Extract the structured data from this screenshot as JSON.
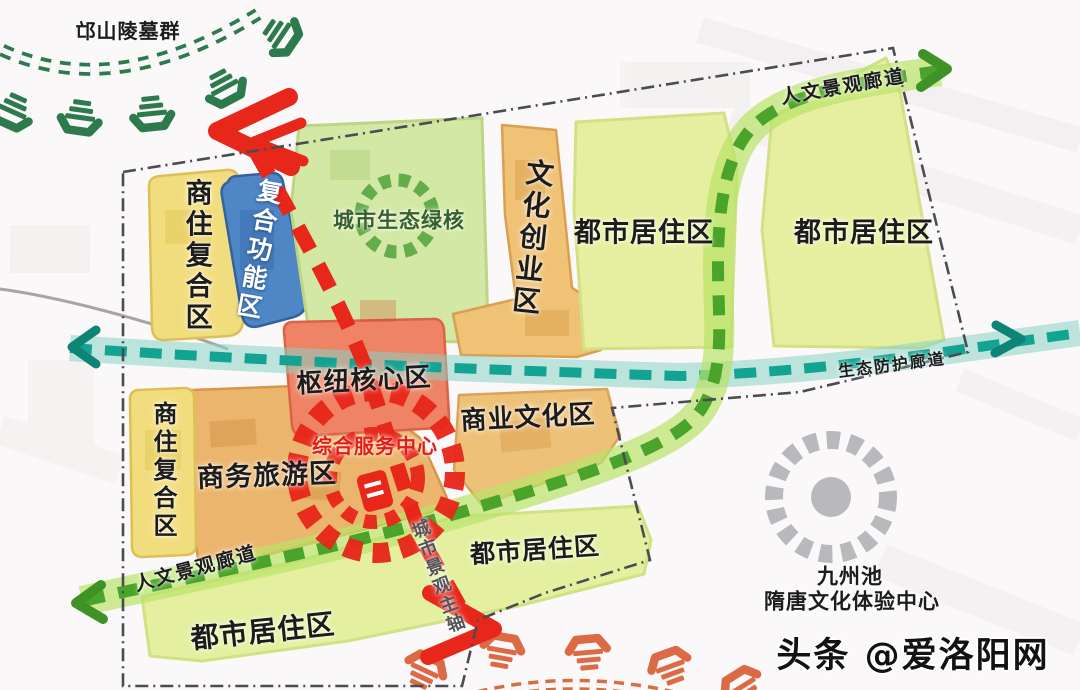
{
  "map": {
    "landmark_top": {
      "label": "邙山陵墓群"
    },
    "zones": {
      "shangzhu_top": {
        "label": "商住复合区",
        "color": "#f2dd7e"
      },
      "fuhe": {
        "label": "复合功能区",
        "color": "#4f86c6"
      },
      "green_core": {
        "label": "城市生态绿核",
        "color": "#d2e8a4"
      },
      "wenchuang": {
        "label": "文化创业区",
        "color": "#f0c276"
      },
      "dushi_top_left": {
        "label": "都市居住区",
        "color": "#e6ef9f"
      },
      "dushi_top_right": {
        "label": "都市居住区",
        "color": "#e6ef9f"
      },
      "hub": {
        "label": "枢纽核心区",
        "color": "#ee8465"
      },
      "shangye_wenhua": {
        "label": "商业文化区",
        "color": "#eec179"
      },
      "shangwu_lvyou": {
        "label": "商务旅游区",
        "color": "#ecb56d"
      },
      "shangzhu_bottom": {
        "label": "商住复合区",
        "color": "#f2dd7e"
      },
      "dushi_mid": {
        "label": "都市居住区",
        "color": "#e4f0a0"
      },
      "dushi_bottom": {
        "label": "都市居住区",
        "color": "#e4f0a0"
      }
    },
    "nodes": {
      "service_center": {
        "label": "综合服务中心",
        "color": "#e8281c"
      },
      "jiuzhou": {
        "line1": "九州池",
        "line2": "隋唐文化体验中心",
        "color": "#b9b9bd"
      }
    },
    "corridors": {
      "renwen_top": {
        "label": "人文景观廊道",
        "color": "#4aa32b"
      },
      "renwen_bottom": {
        "label": "人文景观廊道",
        "color": "#4aa32b"
      },
      "shengtai": {
        "label": "生态防护廊道",
        "color": "#13a392"
      },
      "axis": {
        "label": "城市景观主轴",
        "color": "#e7271a"
      }
    },
    "watermark": "头条 @爱洛阳网"
  }
}
